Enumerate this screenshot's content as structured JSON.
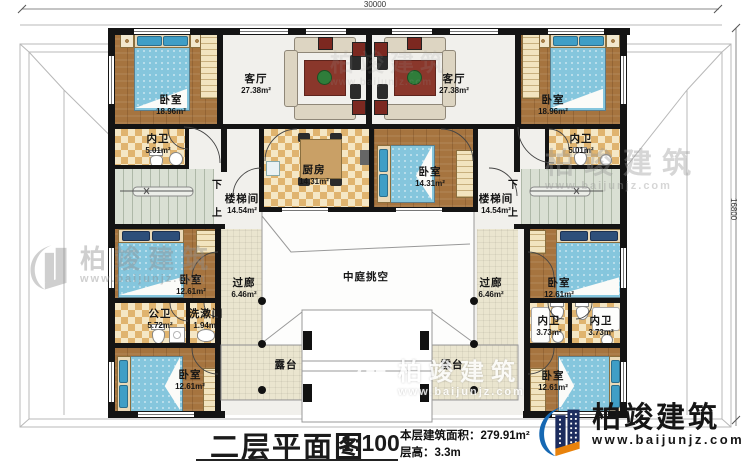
{
  "dimensions": {
    "width_mm": "30000",
    "height_mm": "16800"
  },
  "rooms": {
    "bedroom_tl": {
      "label": "卧室",
      "area": "18.96m²"
    },
    "bedroom_tr": {
      "label": "卧室",
      "area": "18.96m²"
    },
    "living_l": {
      "label": "客厅",
      "area": "27.38m²"
    },
    "living_r": {
      "label": "客厅",
      "area": "27.38m²"
    },
    "bath_tl": {
      "label": "内卫",
      "area": "5.01m²"
    },
    "bath_tr": {
      "label": "内卫",
      "area": "5.01m²"
    },
    "kitchen": {
      "label": "厨房",
      "area": "14.31m²"
    },
    "bedroom_c": {
      "label": "卧室",
      "area": "14.31m²"
    },
    "stair_l": {
      "label": "楼梯间",
      "area": "14.54m²"
    },
    "stair_r": {
      "label": "楼梯间",
      "area": "14.54m²"
    },
    "bedroom_ml": {
      "label": "卧室",
      "area": "12.61m²"
    },
    "bedroom_mr": {
      "label": "卧室",
      "area": "12.61m²"
    },
    "bath_public": {
      "label": "公卫",
      "area": "5.72m²"
    },
    "washroom": {
      "label": "洗漱间",
      "area": "1.94m²"
    },
    "bedroom_bl": {
      "label": "卧室",
      "area": "12.61m²"
    },
    "bedroom_br": {
      "label": "卧室",
      "area": "12.61m²"
    },
    "bath_mr1": {
      "label": "内卫",
      "area": "3.73m²"
    },
    "bath_mr2": {
      "label": "内卫",
      "area": "3.73m²"
    },
    "corridor_l": {
      "label": "过廊",
      "area": "6.46m²"
    },
    "corridor_r": {
      "label": "过廊",
      "area": "6.46m²"
    },
    "atrium": {
      "label": "中庭挑空"
    },
    "terrace_l": {
      "label": "露台"
    },
    "terrace_r": {
      "label": "露台"
    }
  },
  "stairs": {
    "down": "下",
    "up": "上"
  },
  "title_block": {
    "title": "二层平面图",
    "scale": "1:100",
    "area_line": "本层建筑面积：279.91m²",
    "floor_height_line": "层高：3.3m"
  },
  "brand": {
    "name": "柏竣建筑",
    "website": "www.baijunjz.com"
  },
  "watermark": {
    "name": "柏竣建筑",
    "website": "www.baijunjz.com"
  },
  "colors": {
    "wall": "#141414",
    "wood_floor": "#a6743f",
    "tile_dark": "#e0b46f",
    "stair_floor": "#d9dfd3",
    "terrace_floor": "#eae5cf",
    "bed_blue": "#85c6dd",
    "rug_red": "#8a372b",
    "brand_blue": "#1668b3",
    "brand_navy": "#1c2c5e",
    "brand_orange": "#e8820c"
  }
}
